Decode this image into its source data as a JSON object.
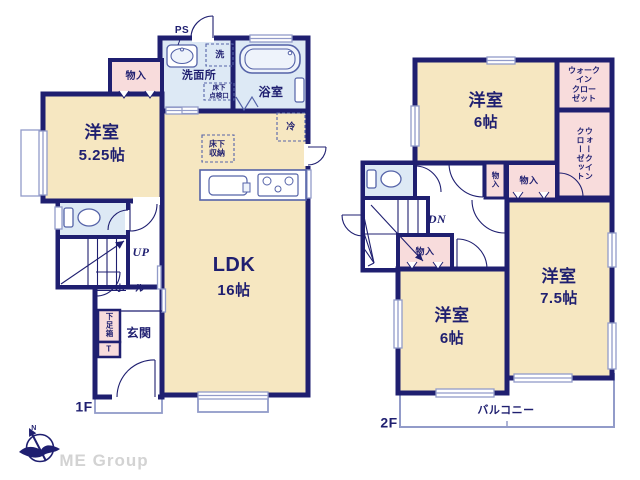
{
  "colors": {
    "wall": "#1f1f70",
    "room_fill": "#f6e7c1",
    "wet_fill": "#dde9f5",
    "closet_fill": "#f8dcdc",
    "light_outline": "#929bc9",
    "fixture_stroke": "#5563a8",
    "brand_gray": "#d3d3d3"
  },
  "floor1": {
    "label": "1F",
    "ps": "PS",
    "washroom": "洗面所",
    "washer": "洗",
    "underfloor_hatch": "床下\n点検口",
    "bathroom": "浴室",
    "closet": "物入",
    "bedroom": {
      "name": "洋室",
      "size": "5.25帖"
    },
    "fridge": "冷",
    "underfloor_storage": "床下\n収納",
    "ldk": {
      "name": "LDK",
      "size": "16帖"
    },
    "stairs": "UP",
    "hall": "ホール",
    "shoe_box": "下足箱",
    "shoe_box_t": "T",
    "entrance": "玄関"
  },
  "floor2": {
    "label": "2F",
    "bedroom_north": {
      "name": "洋室",
      "size": "6帖"
    },
    "wic_north": "ウォーク\nイン\nクロー\nゼット",
    "wic_east": "ウォークイン\nクローゼット",
    "closet_hall_small": "物入",
    "closet_hall": "物入",
    "stairs": "DN",
    "closet_south": "物入",
    "bedroom_south": {
      "name": "洋室",
      "size": "6帖"
    },
    "bedroom_east": {
      "name": "洋室",
      "size": "7.5帖"
    },
    "balcony": "バルコニー"
  },
  "footer": {
    "compass_north": "N",
    "brand": "ME Group"
  }
}
